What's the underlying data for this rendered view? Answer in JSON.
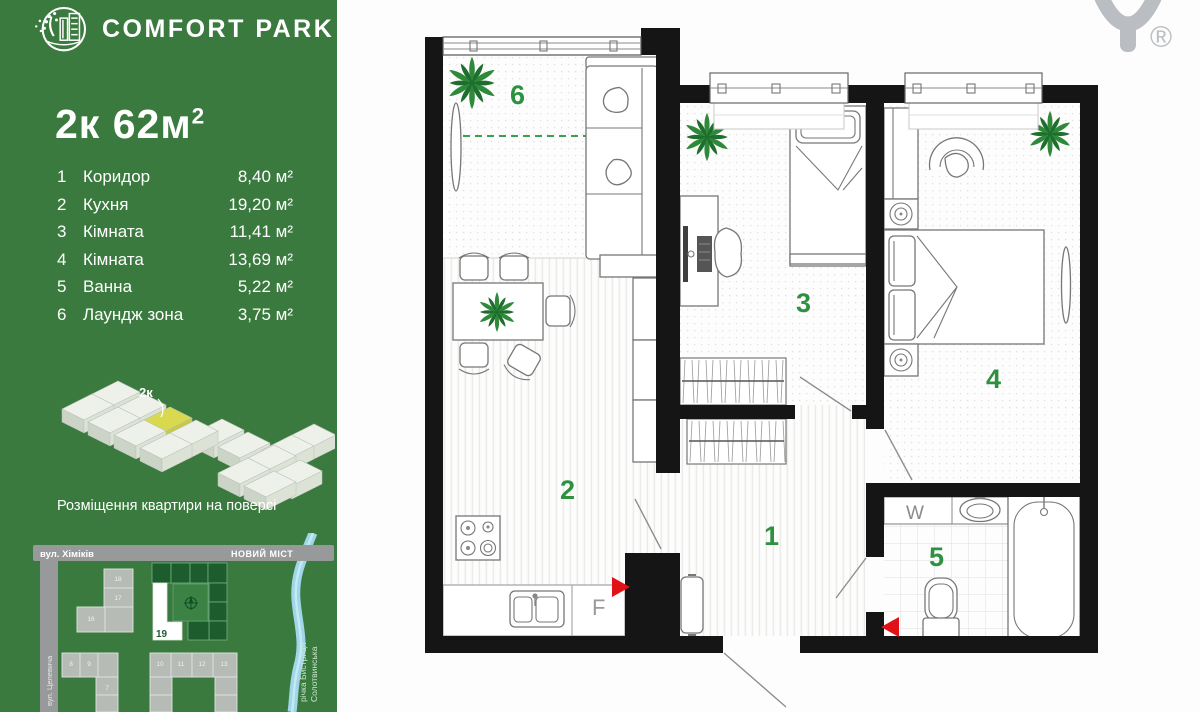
{
  "brand": {
    "name": "COMFORT PARK",
    "registered_mark": "®"
  },
  "unit": {
    "title": "2к 62м",
    "title_sup": "2"
  },
  "rooms": [
    {
      "num": "1",
      "name": "Коридор",
      "area": "8,40 м²"
    },
    {
      "num": "2",
      "name": "Кухня",
      "area": "19,20 м²"
    },
    {
      "num": "3",
      "name": "Кімната",
      "area": "11,41 м²"
    },
    {
      "num": "4",
      "name": "Кімната",
      "area": "13,69 м²"
    },
    {
      "num": "5",
      "name": "Ванна",
      "area": "5,22 м²"
    },
    {
      "num": "6",
      "name": "Лаундж зона",
      "area": "3,75 м²"
    }
  ],
  "floor_diagram": {
    "unit_label": "2к",
    "caption": "Розміщення квартири на поверсі"
  },
  "map": {
    "street_top": "вул. Хіміків",
    "bridge_label": "НОВИЙ МІСТ",
    "street_left": "вул. Целевича",
    "river_line1": "річка Бистриця",
    "river_line2": "Солотвинська",
    "building_label": "19",
    "block_numbers": [
      "18",
      "17",
      "16",
      "8",
      "9",
      "7",
      "10",
      "11",
      "12",
      "13"
    ]
  },
  "plan": {
    "labels": {
      "corridor": "1",
      "kitchen": "2",
      "room3": "3",
      "room4": "4",
      "bath": "5",
      "lounge": "6"
    },
    "washer_label": "W",
    "fridge_label": "F"
  },
  "colors": {
    "sidebar_green": "#3a7a3e",
    "accent_green": "#2e9140",
    "highlight_yellow": "#d8d94f",
    "river_blue": "#9fd6e8",
    "red_marker": "#e01218",
    "dark_complex_green": "#1d5c2d"
  }
}
